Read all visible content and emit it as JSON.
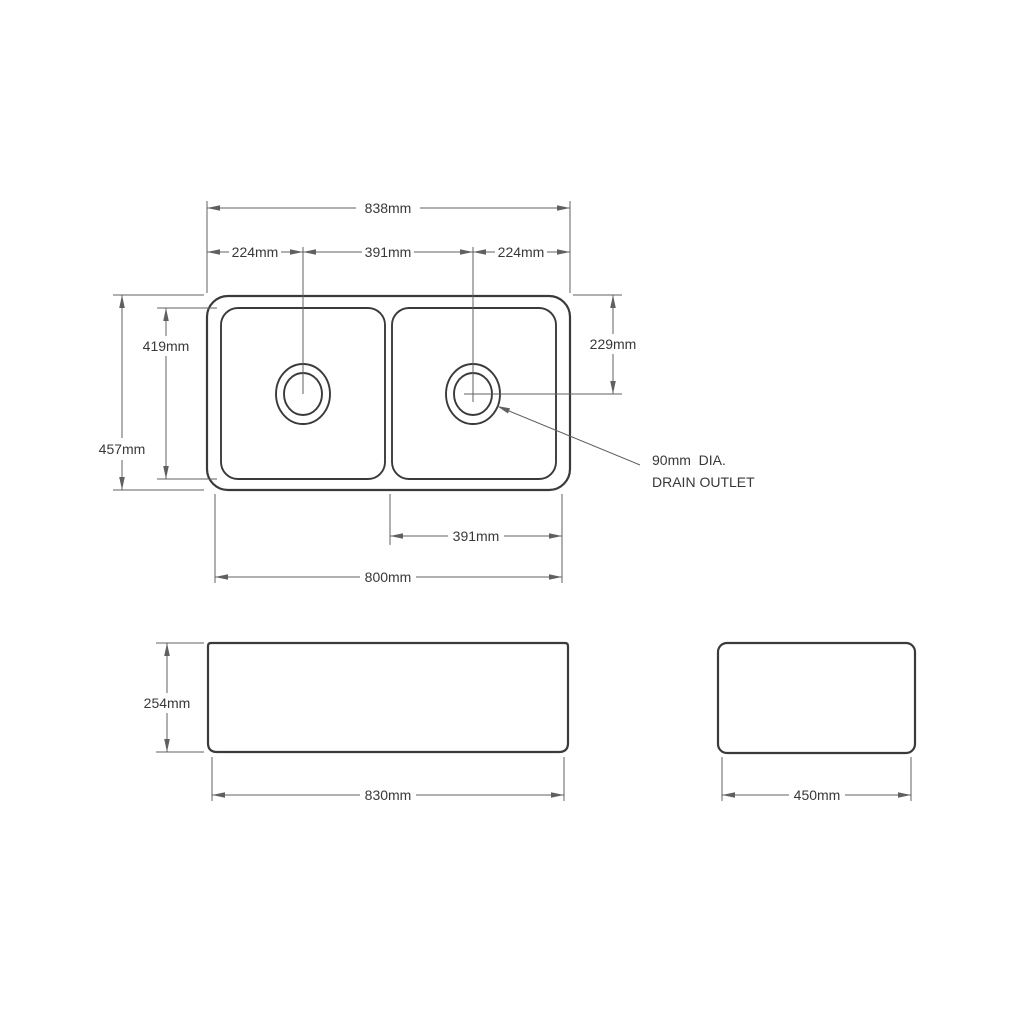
{
  "top_view": {
    "dim_overall_width": "838mm",
    "dim_left_drain_offset": "224mm",
    "dim_drain_spacing": "391mm",
    "dim_right_drain_offset": "224mm",
    "dim_bowl_inner_depth": "419mm",
    "dim_overall_depth": "457mm",
    "dim_drain_center_depth": "229mm",
    "dim_right_bowl_base_width": "391mm",
    "dim_base_width": "800mm",
    "drain_note_line1": "90mm  DIA.",
    "drain_note_line2": "DRAIN OUTLET"
  },
  "front_view": {
    "dim_height": "254mm",
    "dim_width": "830mm"
  },
  "side_view": {
    "dim_width": "450mm"
  },
  "colors": {
    "background": "#ffffff",
    "object_line": "#3a3a3a",
    "dimension_line": "#606060",
    "text": "#383838"
  }
}
